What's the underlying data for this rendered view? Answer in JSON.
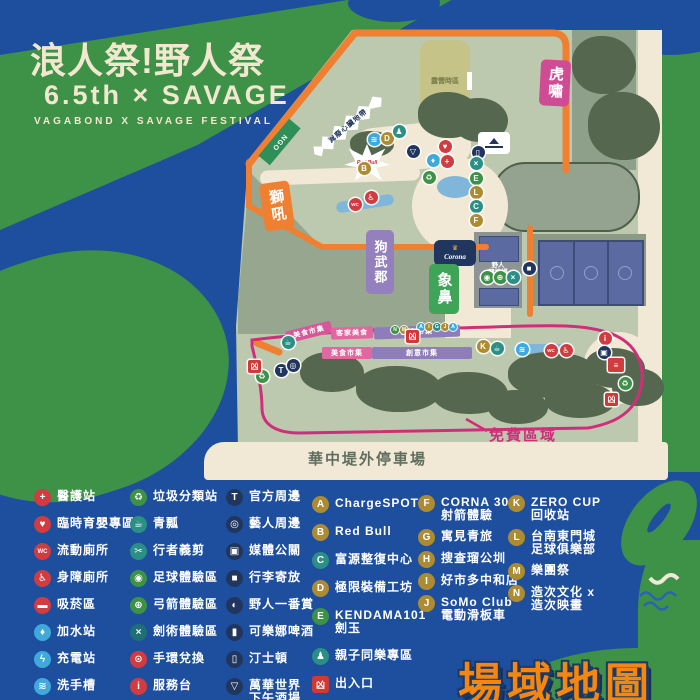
{
  "title": {
    "line1": "浪人祭!野人祭",
    "line2": "6.5th × SAVAGE",
    "line3": "VAGABOND  X  SAVAGE  FESTIVAL"
  },
  "footer_title": "場域地圖",
  "map": {
    "camp": "露營時區",
    "ngo": "NGO",
    "banner": "減廢心臟地帶",
    "redbull": "Red Bull",
    "corona": "Corona",
    "arena1": "野人",
    "arena2": "競技場",
    "parking": "華中堤外停車場",
    "free_zone": "免費區域",
    "stages": [
      {
        "t": "虎嘯",
        "x": 540,
        "y": 60,
        "w": 30,
        "h": 46,
        "bg": "#cf4b94",
        "rot": 3,
        "fs": 15
      },
      {
        "t": "獅吼",
        "x": 262,
        "y": 182,
        "w": 30,
        "h": 48,
        "bg": "#ef8032",
        "rot": -8,
        "fs": 15
      },
      {
        "t": "狗武郡",
        "x": 366,
        "y": 230,
        "w": 28,
        "h": 64,
        "bg": "#9480bd",
        "rot": 0,
        "fs": 13
      },
      {
        "t": "象鼻",
        "x": 429,
        "y": 264,
        "w": 30,
        "h": 50,
        "bg": "#3fa457",
        "rot": 0,
        "fs": 15
      }
    ],
    "bands": [
      {
        "t": "美食市集",
        "x": 286,
        "y": 326,
        "w": 46,
        "h": 12,
        "bg": "#d8569a",
        "rot": -14,
        "fs": 7
      },
      {
        "t": "客家美食",
        "x": 331,
        "y": 327,
        "w": 42,
        "h": 12,
        "bg": "#e0679f",
        "rot": -2,
        "fs": 7
      },
      {
        "t": "創意市集",
        "x": 374,
        "y": 326,
        "w": 86,
        "h": 12,
        "bg": "#8f7cba",
        "rot": -2,
        "fs": 7
      },
      {
        "t": "美食市集",
        "x": 322,
        "y": 347,
        "w": 50,
        "h": 12,
        "bg": "#e0679f",
        "rot": 0,
        "fs": 7
      },
      {
        "t": "創意市集",
        "x": 372,
        "y": 347,
        "w": 100,
        "h": 12,
        "bg": "#8f7cba",
        "rot": 0,
        "fs": 7
      }
    ],
    "markers": [
      {
        "x": 374,
        "y": 139,
        "c": "blue",
        "g": "≋",
        "n": "handwash-marker"
      },
      {
        "x": 387,
        "y": 138,
        "c": "gold",
        "g": "D",
        "n": "booth-d-marker"
      },
      {
        "x": 399,
        "y": 131,
        "c": "teal",
        "g": "♟",
        "n": "kids-area-marker"
      },
      {
        "x": 413,
        "y": 151,
        "c": "navy",
        "g": "▽",
        "n": "bar-marker"
      },
      {
        "x": 433,
        "y": 160,
        "c": "blue",
        "g": "♦",
        "n": "water-station-marker"
      },
      {
        "x": 445,
        "y": 146,
        "c": "red",
        "g": "♥",
        "n": "nursing-marker"
      },
      {
        "x": 447,
        "y": 161,
        "c": "red",
        "g": "+",
        "n": "first-aid-marker"
      },
      {
        "x": 478,
        "y": 152,
        "c": "navy",
        "g": "▯",
        "n": "bottle-marker"
      },
      {
        "x": 429,
        "y": 177,
        "c": "green",
        "g": "♻",
        "n": "recycle-marker"
      },
      {
        "x": 355,
        "y": 204,
        "c": "red",
        "g": "WC",
        "n": "toilet-marker"
      },
      {
        "x": 371,
        "y": 197,
        "c": "red",
        "g": "♿",
        "n": "accessible-toilet-marker"
      },
      {
        "x": 364,
        "y": 168,
        "c": "gold",
        "g": "B",
        "n": "booth-b-marker"
      },
      {
        "x": 476,
        "y": 163,
        "c": "teal",
        "g": "×",
        "n": "fencing-marker"
      },
      {
        "x": 476,
        "y": 178,
        "c": "green",
        "g": "E",
        "n": "booth-e-marker"
      },
      {
        "x": 476,
        "y": 192,
        "c": "gold",
        "g": "L",
        "n": "booth-l-marker"
      },
      {
        "x": 476,
        "y": 206,
        "c": "teal",
        "g": "C",
        "n": "booth-c-marker"
      },
      {
        "x": 476,
        "y": 220,
        "c": "gold",
        "g": "F",
        "n": "booth-f-marker"
      },
      {
        "x": 487,
        "y": 277,
        "c": "green",
        "g": "◉",
        "n": "soccer-marker"
      },
      {
        "x": 500,
        "y": 277,
        "c": "green",
        "g": "⊕",
        "n": "archery-marker"
      },
      {
        "x": 513,
        "y": 277,
        "c": "teal",
        "g": "×",
        "n": "sword-marker"
      },
      {
        "x": 529,
        "y": 268,
        "c": "navy",
        "g": "■",
        "n": "locker-marker"
      },
      {
        "x": 262,
        "y": 376,
        "c": "green",
        "g": "♻",
        "n": "recycle-marker"
      },
      {
        "x": 281,
        "y": 370,
        "c": "navy",
        "g": "T",
        "n": "merch-marker"
      },
      {
        "x": 293,
        "y": 365,
        "c": "navy",
        "g": "◎",
        "n": "artist-merch-marker"
      },
      {
        "x": 288,
        "y": 342,
        "c": "teal",
        "g": "☕",
        "n": "cup-rental-marker"
      },
      {
        "x": 483,
        "y": 346,
        "c": "gold",
        "g": "K",
        "n": "booth-k-marker"
      },
      {
        "x": 497,
        "y": 348,
        "c": "teal",
        "g": "☕",
        "n": "cup-rental-marker"
      },
      {
        "x": 522,
        "y": 349,
        "c": "blue",
        "g": "≋",
        "n": "handwash-marker"
      },
      {
        "x": 551,
        "y": 350,
        "c": "red",
        "g": "WC",
        "n": "toilet-marker"
      },
      {
        "x": 566,
        "y": 350,
        "c": "red",
        "g": "♿",
        "n": "accessible-toilet-marker"
      },
      {
        "x": 605,
        "y": 338,
        "c": "red",
        "g": "i",
        "n": "info-marker"
      },
      {
        "x": 604,
        "y": 352,
        "c": "navy",
        "g": "▣",
        "n": "media-marker"
      },
      {
        "x": 625,
        "y": 383,
        "c": "green",
        "g": "♻",
        "n": "recycle-marker"
      }
    ],
    "dots": [
      {
        "x": 395,
        "y": 330,
        "c": "green",
        "g": "N"
      },
      {
        "x": 404,
        "y": 330,
        "c": "gold",
        "g": "M"
      },
      {
        "x": 421,
        "y": 327,
        "c": "blue",
        "g": "A"
      },
      {
        "x": 429,
        "y": 327,
        "c": "gold",
        "g": "I"
      },
      {
        "x": 437,
        "y": 327,
        "c": "teal",
        "g": "G"
      },
      {
        "x": 445,
        "y": 327,
        "c": "gold",
        "g": "J"
      },
      {
        "x": 453,
        "y": 327,
        "c": "blue",
        "g": "A"
      }
    ],
    "exit_glyph": "凶",
    "exits": [
      {
        "x": 254,
        "y": 366
      },
      {
        "x": 412,
        "y": 336
      },
      {
        "x": 611,
        "y": 399
      }
    ]
  },
  "legend": {
    "cols": [
      {
        "x": 34,
        "y0": 490,
        "step": 27,
        "items": [
          {
            "g": "+",
            "c": "red",
            "t": "醫護站"
          },
          {
            "g": "♥",
            "c": "red",
            "t": "臨時育嬰專區"
          },
          {
            "g": "WC",
            "c": "red",
            "t": "流動廁所"
          },
          {
            "g": "♿",
            "c": "red",
            "t": "身障廁所"
          },
          {
            "g": "▬",
            "c": "red",
            "t": "吸菸區"
          },
          {
            "g": "♦",
            "c": "blue",
            "t": "加水站"
          },
          {
            "g": "ϟ",
            "c": "blue",
            "t": "充電站"
          },
          {
            "g": "≋",
            "c": "blue",
            "t": "洗手槽"
          }
        ]
      },
      {
        "x": 130,
        "y0": 490,
        "step": 27,
        "items": [
          {
            "g": "♻",
            "c": "green",
            "t": "垃圾分類站"
          },
          {
            "g": "☕",
            "c": "teal",
            "t": "青瓢"
          },
          {
            "g": "✂",
            "c": "teal",
            "t": "行者義剪"
          },
          {
            "g": "◉",
            "c": "green",
            "t": "足球體驗區"
          },
          {
            "g": "⊕",
            "c": "green",
            "t": "弓箭體驗區"
          },
          {
            "g": "×",
            "c": "dteal",
            "t": "劍術體驗區"
          },
          {
            "g": "⊙",
            "c": "red",
            "t": "手環兌換"
          },
          {
            "g": "i",
            "c": "red",
            "t": "服務台"
          }
        ]
      },
      {
        "x": 226,
        "y0": 490,
        "step": 27,
        "items": [
          {
            "g": "T",
            "c": "navy",
            "t": "官方周邊"
          },
          {
            "g": "◎",
            "c": "navy",
            "t": "藝人周邊"
          },
          {
            "g": "▣",
            "c": "navy",
            "t": "媒體公關"
          },
          {
            "g": "■",
            "c": "navy",
            "t": "行李寄放"
          },
          {
            "g": "◐",
            "c": "navy",
            "t": "野人一番賞"
          },
          {
            "g": "▮",
            "c": "navy",
            "t": "可樂娜啤酒"
          },
          {
            "g": "▯",
            "c": "navy",
            "t": "汀士頓"
          },
          {
            "g": "▽",
            "c": "navy",
            "t": "萬華世界",
            "t2": "下午酒場"
          }
        ]
      },
      {
        "x": 312,
        "y0": 497,
        "step": 28,
        "items": [
          {
            "g": "A",
            "c": "gold",
            "t": "ChargeSPOT"
          },
          {
            "g": "B",
            "c": "gold",
            "t": "Red Bull"
          },
          {
            "g": "C",
            "c": "teal",
            "t": "富源整復中心"
          },
          {
            "g": "D",
            "c": "gold",
            "t": "極限裝備工坊"
          },
          {
            "g": "E",
            "c": "green",
            "t": "KENDAMA101",
            "t2": "劍玉"
          },
          {
            "g": "♟",
            "c": "teal",
            "t": "親子同樂專區"
          },
          {
            "g": "凶",
            "c": "exit",
            "t": "出入口"
          }
        ]
      },
      {
        "x": 418,
        "y0": 496,
        "step": 22,
        "items": [
          {
            "g": "F",
            "c": "gold",
            "t": "CORNA 30",
            "t2": "射箭體驗"
          },
          {
            "g": "G",
            "c": "gold",
            "t": "寓見青旅"
          },
          {
            "g": "H",
            "c": "gold",
            "t": "搜查瑠公圳"
          },
          {
            "g": "I",
            "c": "gold",
            "t": "好市多中和店"
          },
          {
            "g": "J",
            "c": "gold",
            "t": "SoMo Club",
            "t2": "電動滑板車"
          }
        ]
      },
      {
        "x": 508,
        "y0": 496,
        "step": 22,
        "items": [
          {
            "g": "K",
            "c": "gold",
            "t": "ZERO CUP",
            "t2": "回收站"
          },
          {
            "g": "L",
            "c": "gold",
            "t": "台南東門城",
            "t2": "足球俱樂部"
          },
          {
            "g": "M",
            "c": "gold",
            "t": "樂團祭"
          },
          {
            "g": "N",
            "c": "gold",
            "t": "造次文化 x",
            "t2": "造次映畫"
          }
        ]
      }
    ]
  },
  "colors": {
    "bg": "#1e4f9e",
    "green": "#3e9247",
    "sage": "#bcc9ae",
    "cream": "#f1e9d6",
    "orange": "#ef8032",
    "pink": "#cf2f7a",
    "navy": "#21365e",
    "gold": "#ad8b33",
    "red": "#d13c41",
    "blue": "#3fa9dc",
    "teal": "#2a8f84",
    "dteal": "#1f6f74",
    "green2": "#55a046",
    "purple": "#8f7cba",
    "court": "#5b6aa0",
    "olive": "#c5c387",
    "forest": "#55684f",
    "exit": "#cf3a35",
    "title_orange": "#f5860f"
  }
}
